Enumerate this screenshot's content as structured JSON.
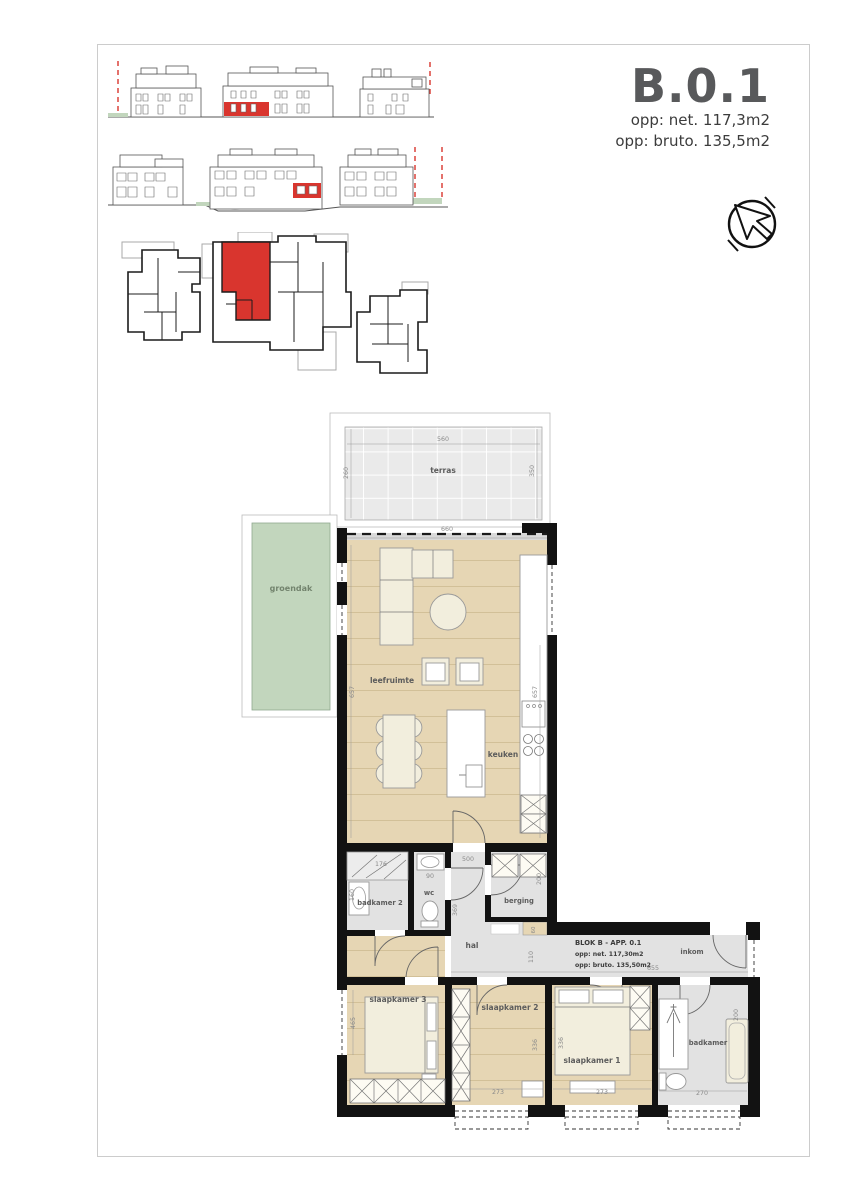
{
  "sheet": {
    "unit": {
      "code": "B.0.1",
      "net": "opp: net. 117,3m2",
      "gross": "opp: bruto. 135,5m2"
    }
  },
  "plan": {
    "info": {
      "line1": "BLOK B - APP. 0.1",
      "line2": "opp: net. 117,30m2",
      "line3": "opp: bruto. 135,50m2"
    },
    "labels": {
      "terras": "terras",
      "groendak": "groendak",
      "leefruimte": "leefruimte",
      "keuken": "keuken",
      "wc": "wc",
      "berging": "berging",
      "badkamer2": "badkamer 2",
      "hal": "hal",
      "slaapkamer3": "slaapkamer 3",
      "slaapkamer2": "slaapkamer 2",
      "slaapkamer1": "slaapkamer 1",
      "badkamer": "badkamer",
      "inkom": "inkom"
    },
    "dims": {
      "terras_w": "560",
      "terras_d_left": "260",
      "terras_d_right": "350",
      "living_w": "660",
      "living_d": "657",
      "shower_w": "176",
      "basin_d": "160",
      "wc_w": "90",
      "hal_w": "500",
      "berging_d": "200",
      "shaft_w": "60",
      "hal_d": "369",
      "hal_strip_d": "110",
      "entry_w": "655",
      "bed3_d": "465",
      "bed2_d": "336",
      "bed2_w": "273",
      "bed1_d": "336",
      "bed1_w": "273",
      "bath_w": "270",
      "bath_d": "200"
    }
  },
  "colors": {
    "highlight": "#d9352e",
    "wall": "#121212",
    "wood": "#e6d6b4",
    "wood_line": "#d2c098",
    "tile": "#eaeaea",
    "gray_floor": "#e2e2e2",
    "grass": "#c2d6bd",
    "cream": "#f2eedd",
    "title_gray": "#58595b"
  }
}
